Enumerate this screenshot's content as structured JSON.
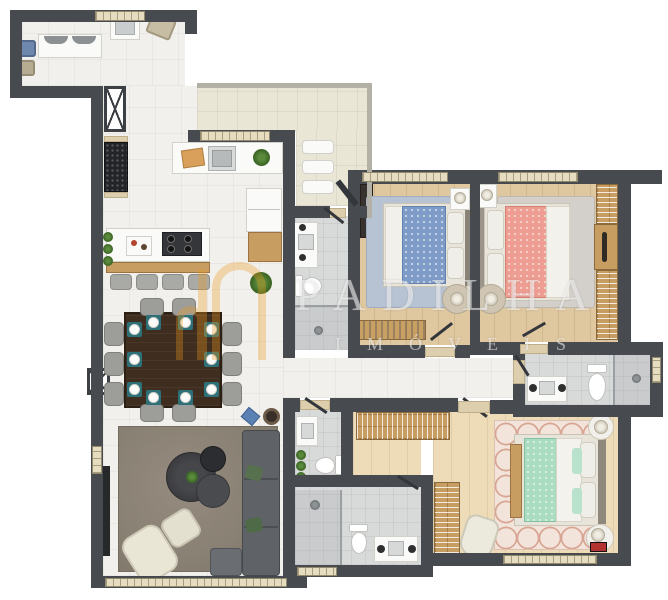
{
  "watermark": {
    "title": "PADILHA",
    "subtitle": "IMÓVEIS",
    "logo": "building-arches-logo",
    "logo_color": "#f09a1e"
  },
  "palette": {
    "wall": "#474a4f",
    "tile_floor": "#f1f0ec",
    "terrace_floor": "#e9e6d6",
    "bath_floor": "#d8dada",
    "wood_floor": "#dfc79f",
    "wood_floor_light": "#eedcb8",
    "wardrobe_wood": "#c89d62",
    "window_frame": "#e6ddc0",
    "bed_blue": "#7e9cc7",
    "bed_pink": "#ee9d92",
    "bed_mint": "#a9dcc0",
    "sofa_gray": "#5f6266",
    "living_rug": "#8a8175",
    "dining_table": "#3f2d1f",
    "placemat_teal": "#2d7078"
  }
}
